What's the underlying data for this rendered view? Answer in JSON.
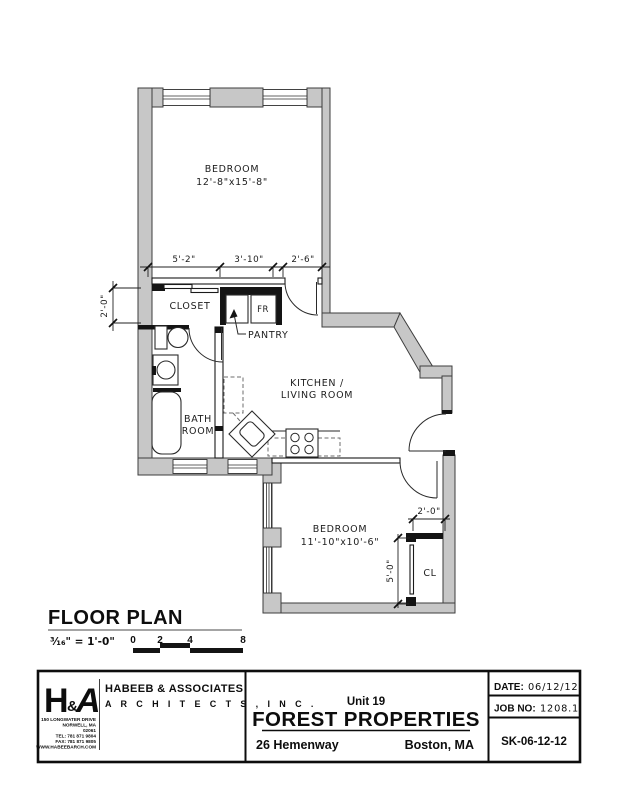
{
  "plan": {
    "bedroom1": {
      "label": "BEDROOM",
      "dims": "12'-8\"x15'-8\""
    },
    "bedroom2": {
      "label": "BEDROOM",
      "dims": "11'-10\"x10'-6\""
    },
    "kitchen": {
      "line1": "KITCHEN /",
      "line2": "LIVING ROOM"
    },
    "bath": {
      "line1": "BATH",
      "line2": "ROOM"
    },
    "closet_label": "CLOSET",
    "pantry_label": "PANTRY",
    "fridge_label": "FR",
    "cl_label": "CL",
    "dims": {
      "d5_2": "5'-2\"",
      "d3_10": "3'-10\"",
      "d2_6": "2'-6\"",
      "d2_0_closet": "2'-0\"",
      "d2_0_cl": "2'-0\"",
      "d5_0": "5'-0\""
    }
  },
  "scale_block": {
    "title": "FLOOR PLAN",
    "ratio": "³⁄₁₆\" = 1'-0\"",
    "ticks": [
      "0",
      "2",
      "4",
      "8"
    ]
  },
  "title_block": {
    "logo": {
      "h": "H",
      "amp": "&",
      "a": "A"
    },
    "firm_line1": "HABEEB & ASSOCIATES",
    "firm_line2": "A R C H I T E C T S ,  I N C .",
    "address_lines": [
      "150 LONGWATER DRIVE",
      "NORWELL, MA",
      "02061",
      "TEL: 781 871 9804",
      "FAX: 781 871 9805",
      "WWW.HABEEBARCH.COM"
    ],
    "unit": "Unit 19",
    "project": "FOREST PROPERTIES",
    "street": "26 Hemenway",
    "city": "Boston, MA",
    "date_label": "DATE:",
    "date_value": "06/12/12",
    "job_label": "JOB NO:",
    "job_value": "1208.1",
    "sheet": "SK-06-12-12"
  }
}
